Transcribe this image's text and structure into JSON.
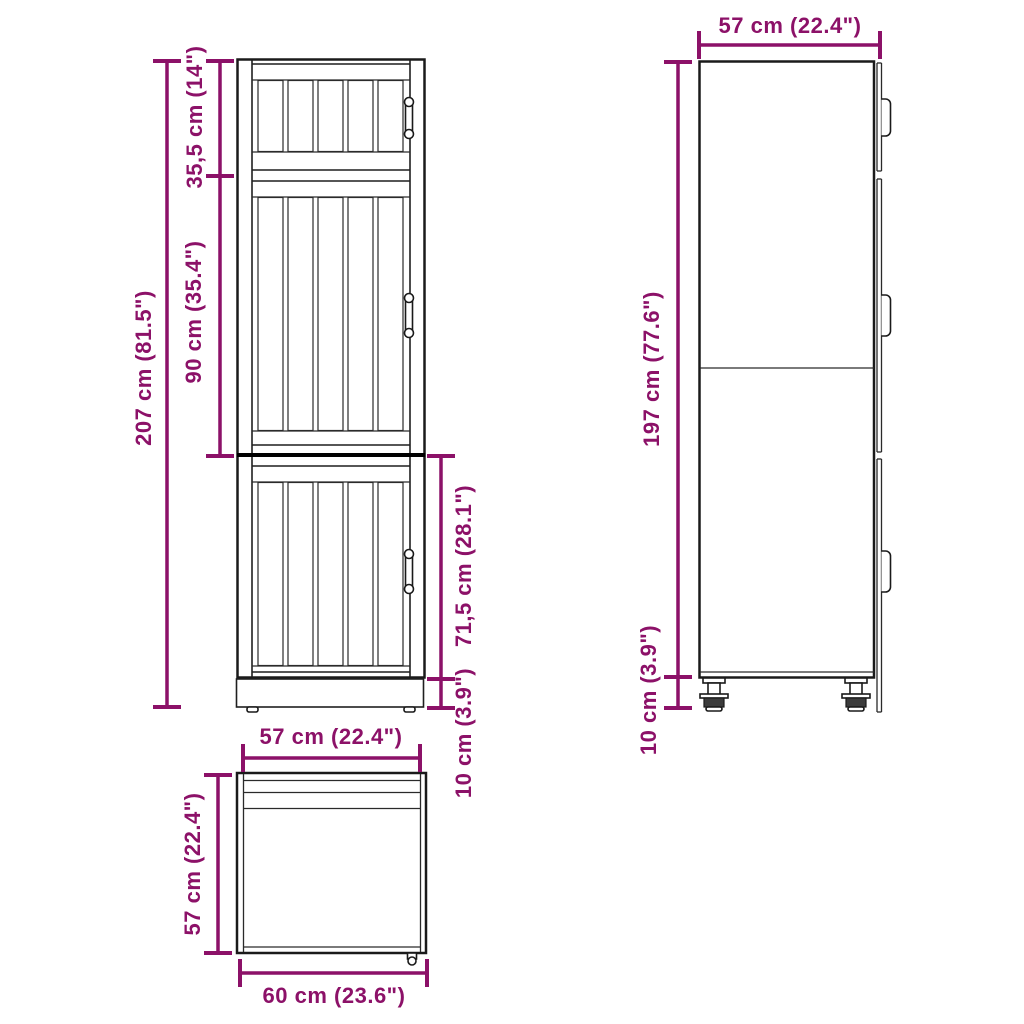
{
  "colors": {
    "dimension": "#8C1168",
    "line": "#1a1a1a",
    "background": "#ffffff"
  },
  "views": {
    "front": {
      "dimensions": {
        "total_height": "207 cm (81.5\")",
        "top_section_height": "35,5 cm (14\")",
        "middle_section_height": "90 cm (35.4\")",
        "bottom_section_height": "71,5 cm (28.1\")",
        "plinth_height": "10 cm (3.9\")"
      }
    },
    "side": {
      "dimensions": {
        "depth": "57 cm (22.4\")",
        "body_height": "197 cm (77.6\")",
        "leg_height": "10 cm (3.9\")"
      }
    },
    "top": {
      "dimensions": {
        "width": "57 cm (22.4\")",
        "depth": "57 cm (22.4\")",
        "total_width": "60 cm (23.6\")"
      }
    }
  }
}
